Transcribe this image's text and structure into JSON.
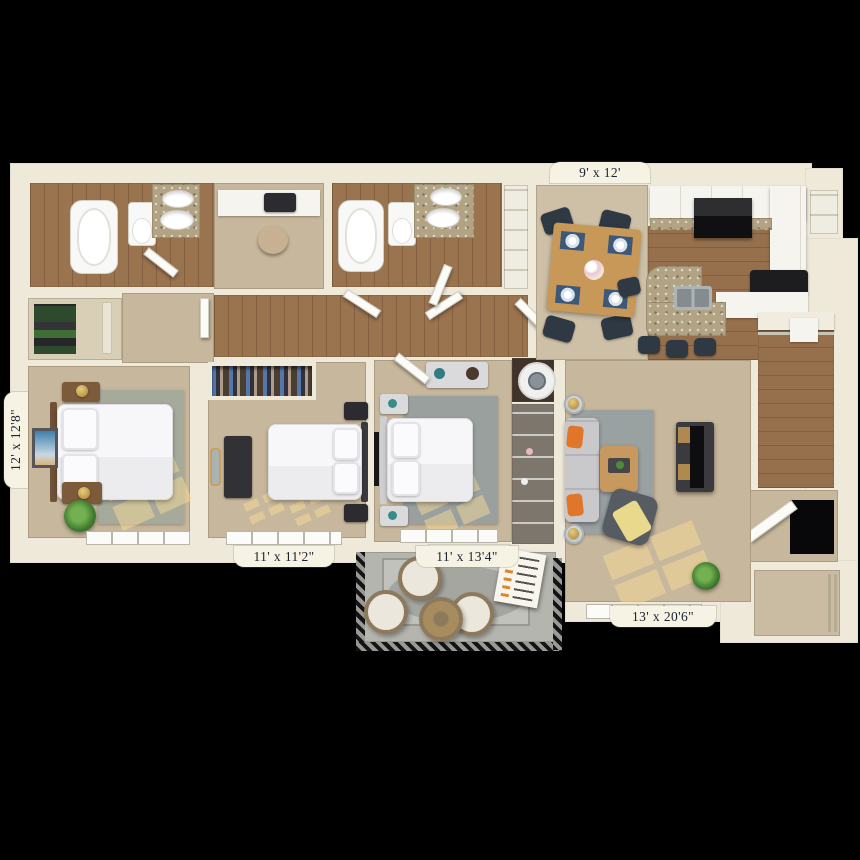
{
  "floor_plan": {
    "labels": {
      "dining": "9' x 12'",
      "master_bedroom": "12' x 12'8\"",
      "bedroom_2": "11' x 11'2\"",
      "bedroom_3": "11' x 13'4\"",
      "living_room": "13' x 20'6\""
    },
    "palette": {
      "background": "#000000",
      "wall": "#efe9da",
      "carpet": "#c7b79c",
      "wood_floor": "#9a734f",
      "granite_counter": "#b1a384",
      "area_rug_gray": "#9aa1a1",
      "pillow_orange": "#e0762a",
      "throw_yellow": "#e8d98c",
      "chair_navy": "#2e3944",
      "label_text": "#1b2231"
    }
  }
}
